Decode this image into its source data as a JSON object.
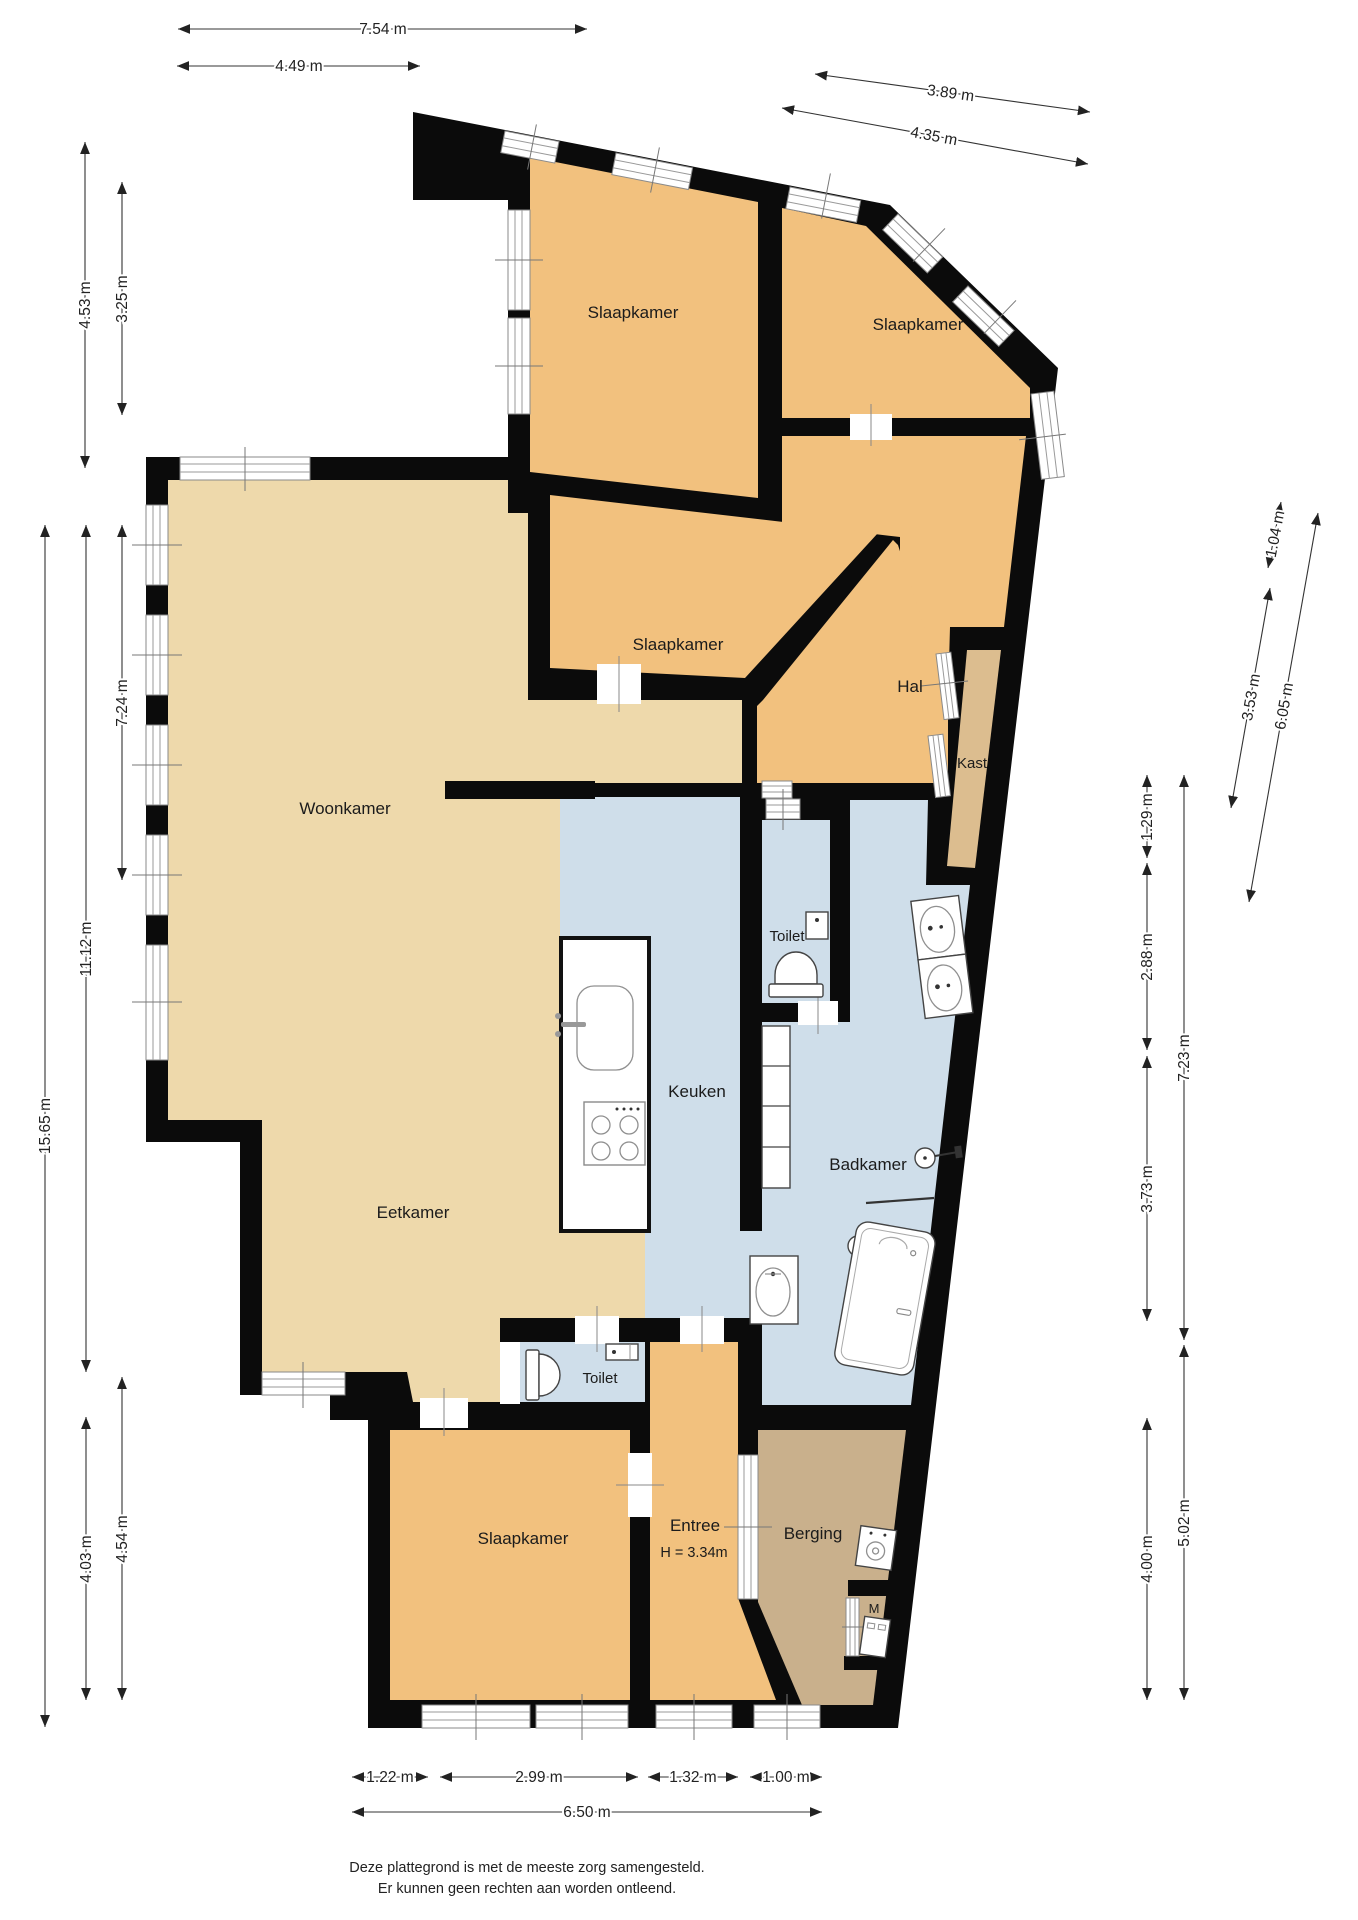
{
  "rooms": {
    "slaapkamer_tl": "Slaapkamer",
    "slaapkamer_tr": "Slaapkamer",
    "slaapkamer_mid": "Slaapkamer",
    "slaapkamer_bottom": "Slaapkamer",
    "woonkamer": "Woonkamer",
    "eetkamer": "Eetkamer",
    "keuken": "Keuken",
    "badkamer": "Badkamer",
    "toilet_upper": "Toilet",
    "toilet_lower": "Toilet",
    "hal": "Hal",
    "kast": "Kast",
    "entree": "Entree",
    "entree_height": "H = 3.34m",
    "berging": "Berging",
    "washer_label": "M"
  },
  "dimensions": {
    "top": [
      "7.54 m",
      "4.49 m",
      "3.89 m",
      "4.35 m"
    ],
    "left": [
      "4.53 m",
      "3.25 m",
      "15.65 m",
      "11.12 m",
      "7.24 m",
      "4.03 m",
      "4.54 m"
    ],
    "right": [
      "1.29 m",
      "2.88 m",
      "3.73 m",
      "4.00 m",
      "7.23 m",
      "5.02 m"
    ],
    "right_slanted": [
      "1.04 m",
      "3.53 m",
      "6.05 m"
    ],
    "bottom": [
      "1.22 m",
      "2.99 m",
      "1.32 m",
      "1.00 m",
      "6.50 m"
    ]
  },
  "footer": {
    "line1": "Deze plattegrond is met de meeste zorg samengesteld.",
    "line2": "Er kunnen geen rechten aan worden ontleend."
  },
  "colors": {
    "wall": "#0b0b0b",
    "floor_tan": "#eed9ab",
    "floor_orange": "#f2c17e",
    "floor_blue": "#cfdeea",
    "floor_kast": "#dcbd8f",
    "floor_berging": "#c9b08c"
  }
}
